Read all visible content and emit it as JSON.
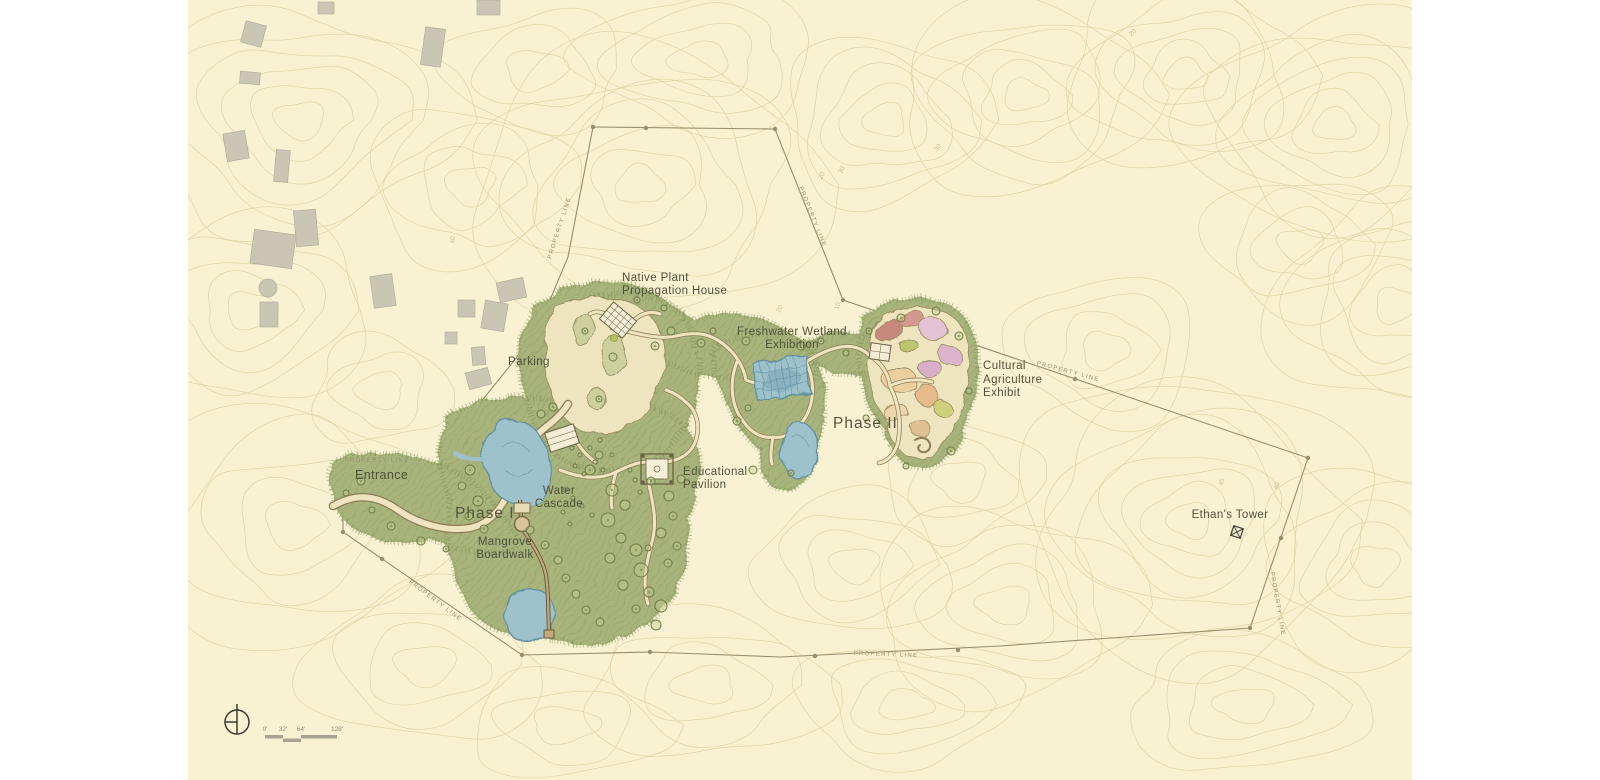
{
  "sheet": {
    "kind": "landscape-master-plan"
  },
  "labels": {
    "entrance": "Entrance",
    "parking": "Parking",
    "phase_1": "Phase I",
    "phase_2": "Phase II",
    "native_plant_propagation_house": "Native Plant\nPropagation House",
    "freshwater_wetland_exhibition": "Freshwater Wetland\nExhibition",
    "cultural_agriculture_exhibit": "Cultural\nAgriculture\nExhibit",
    "water_cascade": "Water\nCascade",
    "mangrove_boardwalk": "Mangrove\nBoardwalk",
    "educational_pavilion": "Educational\nPavilion",
    "ethans_tower": "Ethan's Tower",
    "property_line": "PROPERTY LINE"
  },
  "contour_labels": [
    {
      "text": "20"
    },
    {
      "text": "10"
    },
    {
      "text": "20"
    },
    {
      "text": "30"
    },
    {
      "text": "45"
    },
    {
      "text": "40"
    },
    {
      "text": "40"
    },
    {
      "text": "30"
    },
    {
      "text": "20"
    }
  ],
  "scale_bar": {
    "ticks": [
      "0'",
      "32'",
      "64'",
      "128'"
    ]
  },
  "colors": {
    "paper": "#ffffff",
    "sheet": "#f8f2d3",
    "contour": "#ddd1a2",
    "vegetation": "#a8b47c",
    "vegetation_dark": "#788b50",
    "path_fill": "#eee4bd",
    "path_edge": "#8d7c57",
    "water": "#9dc2cc",
    "water_edge": "#5f8fa0",
    "neighbor_building": "#cbc6b4",
    "property_line": "#968e6c",
    "label_ink": "#50503a",
    "crop_beds": [
      "#c6897e",
      "#d4998e",
      "#e2c2d3",
      "#dcb5cd",
      "#bcc46e",
      "#d9aec8",
      "#eccf9f",
      "#e6ba8a",
      "#ecd5ab",
      "#e0c193",
      "#cfd07e"
    ]
  }
}
